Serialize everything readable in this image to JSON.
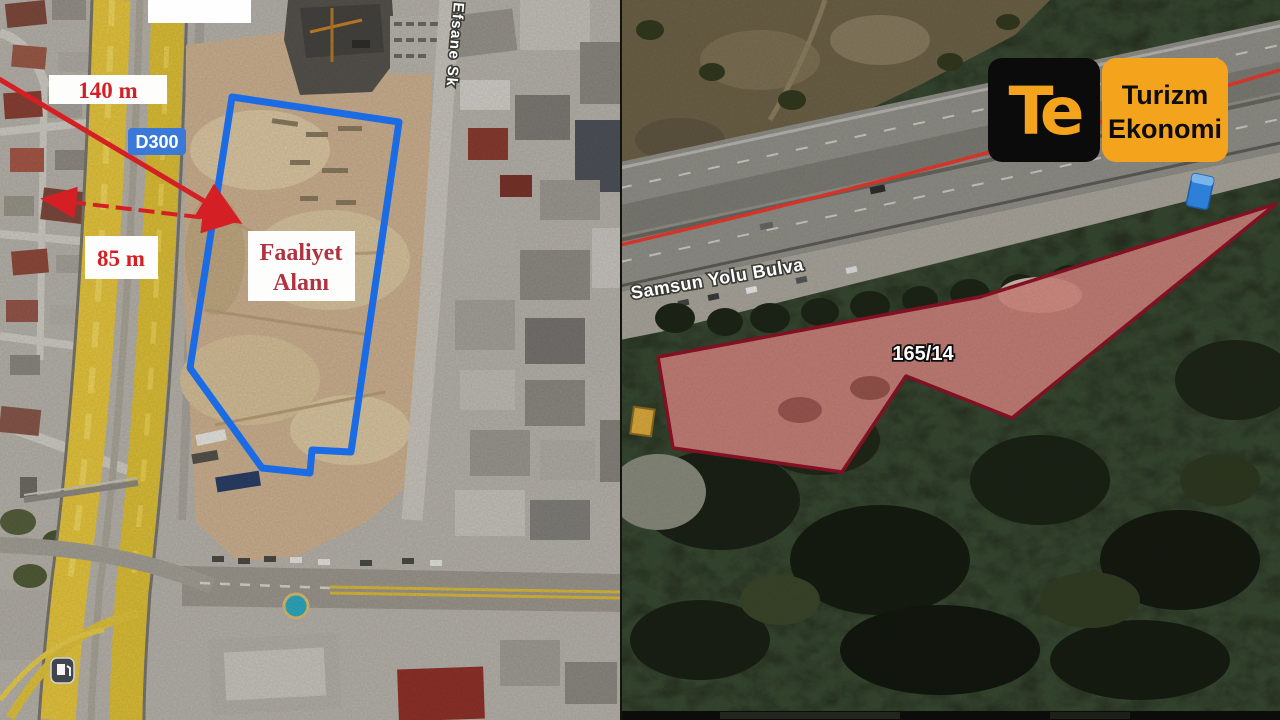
{
  "left_map": {
    "distance_label_1": "140 m",
    "distance_label_2": "85 m",
    "road_badge": "D300",
    "site_label_line1": "Faaliyet",
    "site_label_line2": "Alanı",
    "street_label": "Efsane Sk"
  },
  "right_map": {
    "road_label": "Samsun Yolu Bulva",
    "parcel_label": "165/14",
    "logo": {
      "monogram": "Te",
      "line1": "Turizm",
      "line2": "Ekonomi"
    }
  },
  "colors": {
    "site_outline": "#1a6be4",
    "measure_red": "#d42025",
    "site_text_red": "#b03340",
    "badge_blue": "#3a79d8",
    "parcel_outline": "#8e1226",
    "parcel_fill": "rgba(214,62,66,0.38)",
    "route_red": "#e6392c",
    "logo_orange": "#f4a31c",
    "logo_black": "#0b0b0b"
  }
}
